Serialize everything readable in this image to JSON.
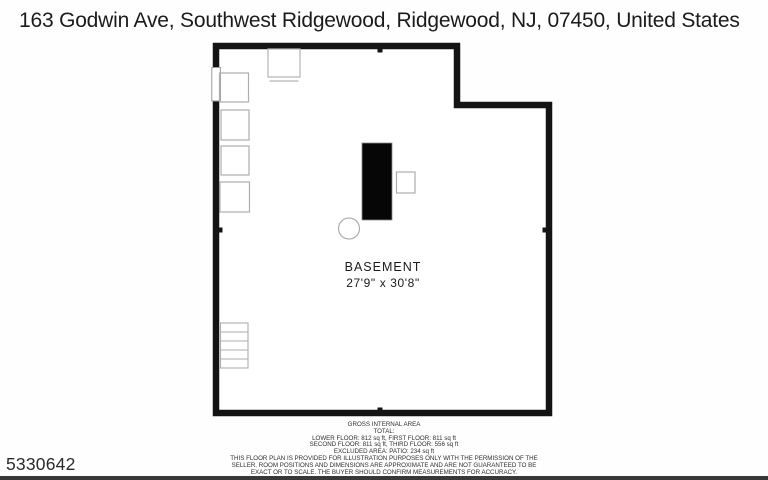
{
  "page": {
    "title": "163 Godwin Ave, Southwest Ridgewood, Ridgewood, NJ, 07450, United States",
    "listing_id": "5330642"
  },
  "floor_plan": {
    "room_label": "BASEMENT",
    "room_dimensions": "27'9\" x 30'8\"",
    "colors": {
      "wall": "#141414",
      "furniture_outline": "#aeaeae",
      "furnace_fill": "#060606",
      "bottom_bar": "#383838"
    }
  },
  "footer": {
    "heading": "GROSS INTERNAL AREA",
    "total_label": "TOTAL:",
    "floors_line_1": "LOWER FLOOR: 812 sq ft, FIRST FLOOR: 811 sq ft",
    "floors_line_2": "SECOND FLOOR: 811 sq ft, THIRD FLOOR: 556 sq ft",
    "excluded_line": "EXCLUDED AREA: PATIO: 234 sq ft",
    "disclaimer": "THIS FLOOR PLAN IS PROVIDED FOR ILLUSTRATION PURPOSES ONLY WITH THE PERMISSION OF THE SELLER. ROOM POSITIONS AND DIMENSIONS ARE APPROXIMATE AND ARE NOT GUARANTEED TO BE EXACT OR TO SCALE. THE BUYER SHOULD CONFIRM MEASUREMENTS FOR ACCURACY."
  }
}
